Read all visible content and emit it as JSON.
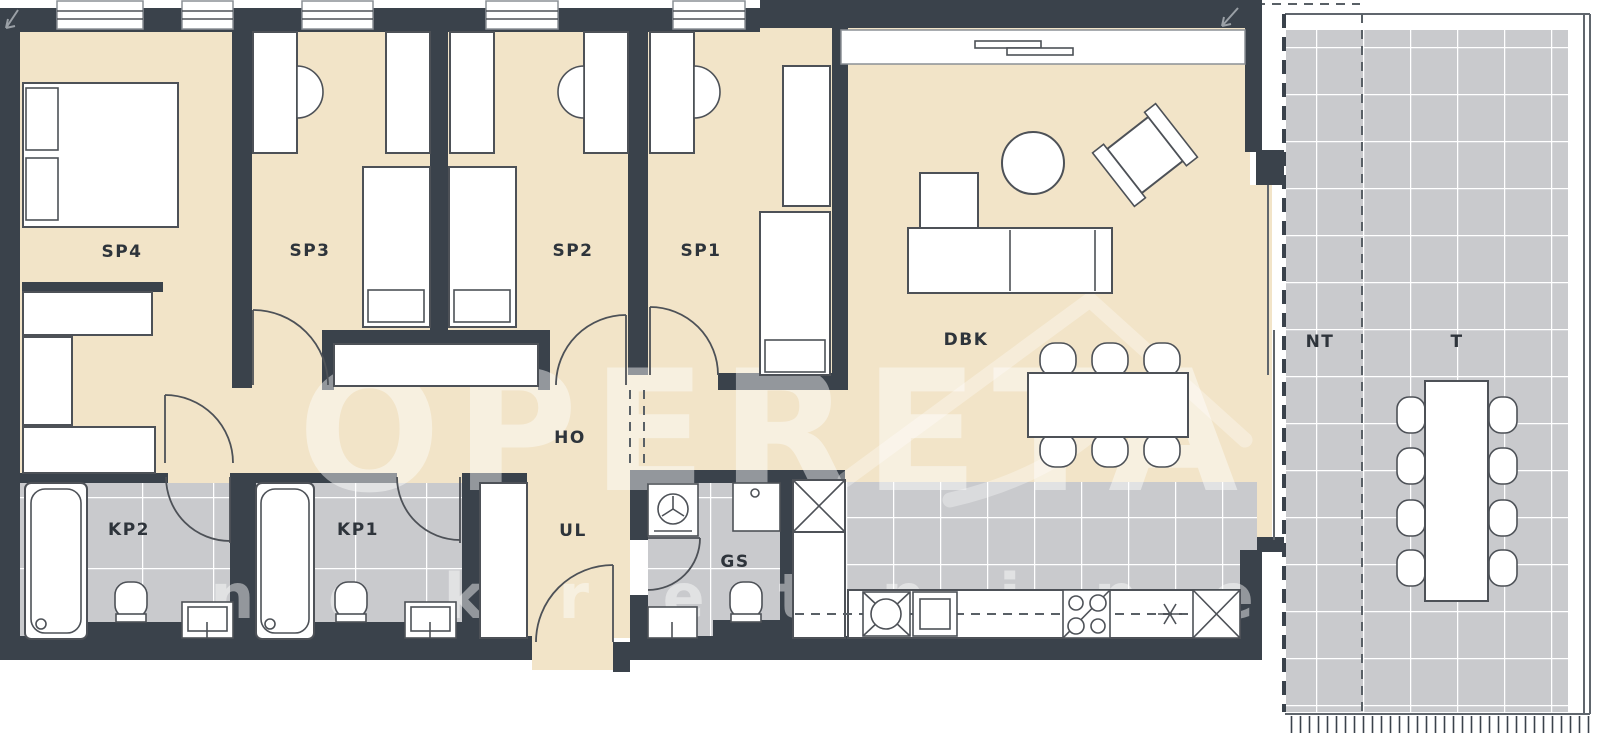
{
  "plan": {
    "labels": {
      "sp4": "SP4",
      "sp3": "SP3",
      "sp2": "SP2",
      "sp1": "SP1",
      "dbk": "DBK",
      "ho": "HO",
      "ul": "UL",
      "gs": "GS",
      "kp2": "KP2",
      "kp1": "KP1",
      "nt": "NT",
      "t": "T"
    },
    "watermark": {
      "brand": "OPERETA",
      "tagline": "n e k r e t n i n e"
    },
    "colors": {
      "wall": "#3a424b",
      "floor": "#f2e4c8",
      "tile": "#c9cacd",
      "stroke": "#4d5157",
      "door": "#4d5157",
      "label": "#2e343b"
    }
  }
}
